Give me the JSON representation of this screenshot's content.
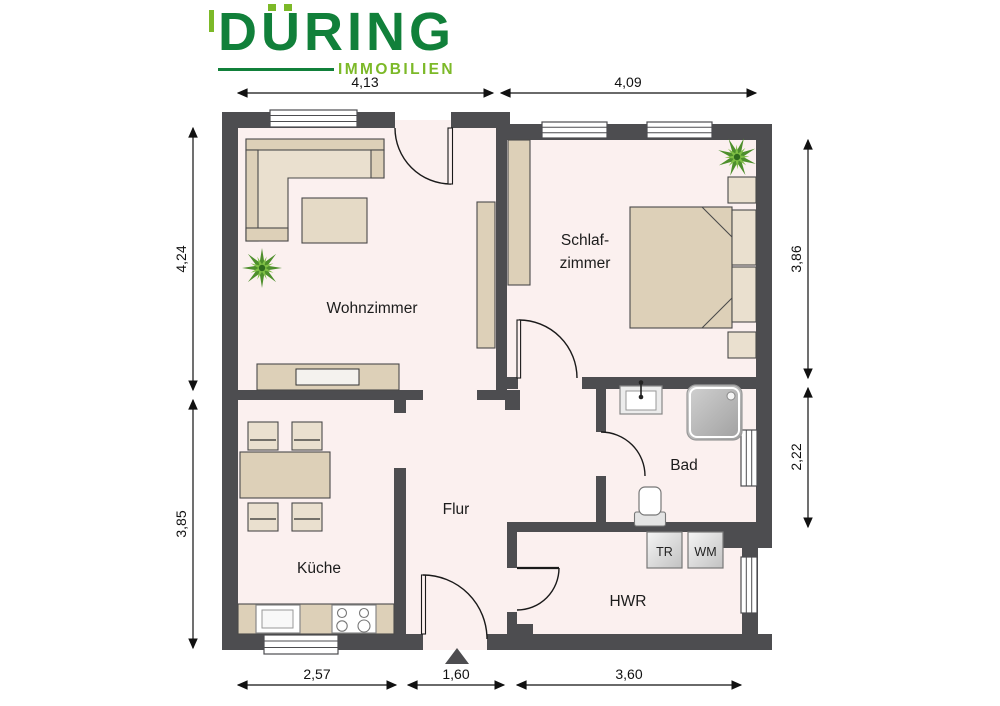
{
  "logo": {
    "name": "DÜRING",
    "word_d": "D",
    "word_u": "U",
    "word_rest": "RING",
    "subtitle": "IMMOBILIEN",
    "brand_dark_green": "#11803a",
    "brand_light_green": "#7cb928"
  },
  "rooms": {
    "living": "Wohnzimmer",
    "bedroom_line1": "Schlaf-",
    "bedroom_line2": "zimmer",
    "kitchen": "Küche",
    "hall": "Flur",
    "bath": "Bad",
    "utility": "HWR"
  },
  "appliances": {
    "dryer": "TR",
    "washer": "WM"
  },
  "dimensions": {
    "top_left": "4,13",
    "top_right": "4,09",
    "left_upper": "4,24",
    "left_lower": "3,85",
    "right_upper": "3,86",
    "right_lower": "2,22",
    "bottom_left": "2,57",
    "bottom_middle": "1,60",
    "bottom_right": "3,60"
  },
  "colors": {
    "wall": "#4d4d50",
    "floor": "#fbf0ef",
    "furniture_beige": "#ddd0b8",
    "furniture_light": "#eae0cf",
    "plant_green": "#4e8f2c",
    "plant_light_green": "#7fbf45"
  }
}
